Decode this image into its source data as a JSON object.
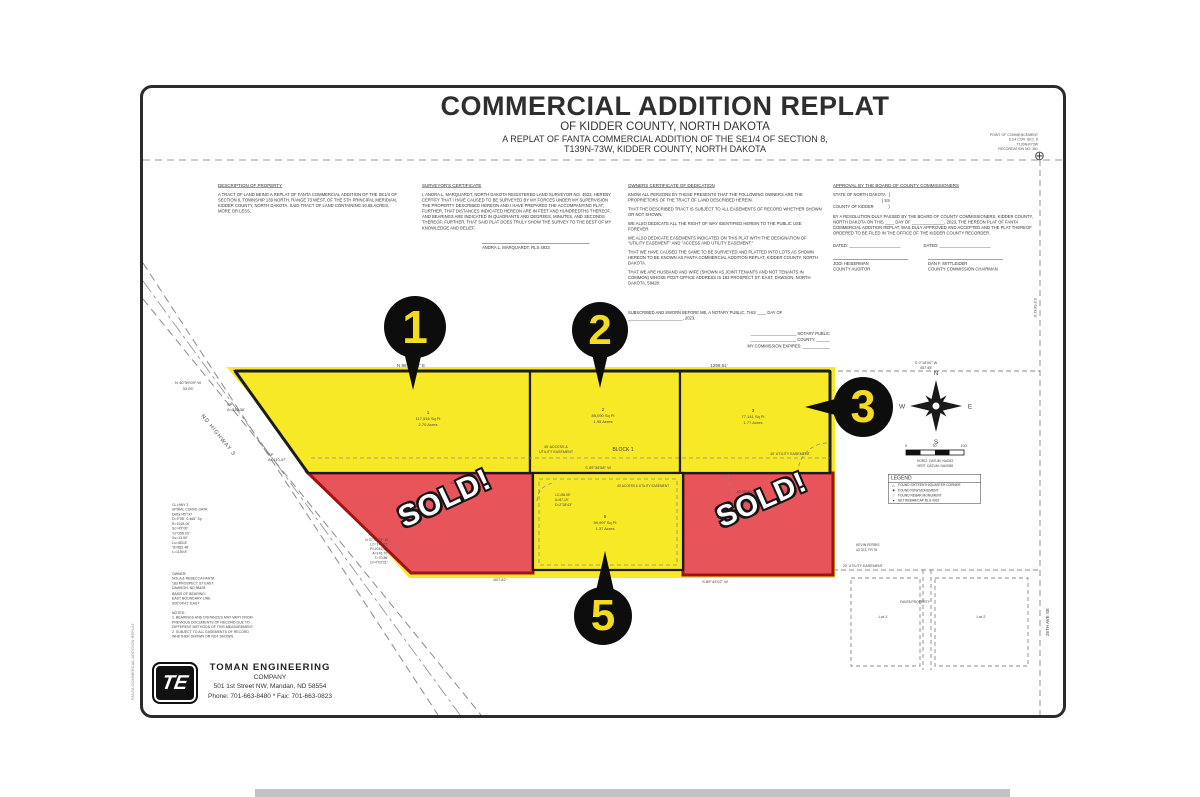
{
  "title": {
    "main": "COMMERCIAL ADDITION REPLAT",
    "sub1": "OF KIDDER COUNTY, NORTH DAKOTA",
    "sub2": "A REPLAT OF FANTA COMMERCIAL ADDITION OF THE SE1/4 OF SECTION 8,",
    "sub3": "T139N-73W, KIDDER COUNTY, NORTH DAKOTA"
  },
  "poc": {
    "l1": "POINT OF COMMENCEMENT",
    "l2": "E1/4 COR. SEC. 8",
    "l3": "T139N-R73W",
    "l4": "RECORDATION NO. 381",
    "symbol": "⊕"
  },
  "certificates": {
    "description": {
      "heading": "DESCRIPTION OF PROPERTY",
      "body": "A TRACT OF LAND BEING A REPLAT OF FANTA COMMERCIAL ADDITION OF THE SE1/4 OF SECTION 8, TOWNSHIP 139 NORTH, RANGE 73 WEST, OF THE 5TH PRINCIPAL MERIDIAN, KIDDER COUNTY, NORTH DAKOTA. SAID TRACT OF LAND CONTAINING 10.68 ACRES, MORE OR LESS."
    },
    "surveyor": {
      "heading": "SURVEYOR'S CERTIFICATE",
      "body": "I, ANDRA L. MARQUARDT, NORTH DAKOTA REGISTERED LAND SURVEYOR NO. 4933, HEREBY CERTIFY THAT I HAVE CAUSED TO BE SURVEYED BY MY FORCES UNDER MY SUPERVISION THE PROPERTY DESCRIBED HEREON AND I HAVE PREPARED THE ACCOMPANYING PLAT; FURTHER, THAT DISTANCES INDICATED HEREON ARE IN FEET AND HUNDREDTHS THEREOF, AND BEARINGS ARE INDICATED IN QUADRANTS AND DEGREES, MINUTES, AND SECONDS THEREOF; FURTHER, THAT SAID PLAT DOES TRULY SHOW THE SURVEY TO THE BEST OF MY KNOWLEDGE AND BELIEF.",
      "signature": "ANDRA L. MARQUARDT, RLS 4933"
    },
    "owners": {
      "heading": "OWNERS CERTIFICATE OF DEDICATION",
      "p1": "KNOW ALL PERSONS BY THESE PRESENTS THAT THE FOLLOWING OWNERS ARE THE PROPRIETORS OF THE TRACT OF LAND DESCRIBED HEREIN.",
      "p2": "THAT THE DESCRIBED TRACT IS SUBJECT TO ALL EASEMENTS OF RECORD WHETHER SHOWN OR NOT SHOWN.",
      "p3": "WE ALSO DEDICATE ALL THE RIGHT OF WAY IDENTIFIED HEREIN TO THE PUBLIC USE FOREVER.",
      "p4": "WE ALSO DEDICATE EASEMENTS INDICATED ON THIS PLAT WITH THE DESIGNATION OF \"UTILITY EASEMENT\" AND \"ACCESS AND UTILITY EASEMENT.\"",
      "p5": "THAT WE HAVE CAUSED THE SAME TO BE SURVEYED AND PLATTED INTO LOTS AS SHOWN HEREON TO BE KNOWN AS FANTA COMMERCIAL ADDITION REPLAT, KIDDER COUNTY, NORTH DAKOTA.",
      "p6": "THAT WE ARE HUSBAND AND WIFE (SHOWN AS JOINT TENANTS AND NOT TENANTS IN COMMON) WHOSE POST OFFICE ADDRESS IS 183 PROSPECT ST. EAST, DAWSON, NORTH DAKOTA, 58428.",
      "notary": "SUBSCRIBED AND SWORN BEFORE ME, A NOTARY PUBLIC, THIS ____ DAY OF\n________________________, 2023.",
      "notary_right": "____________________ NOTARY PUBLIC\n____________________ COUNTY, ______\nMY COMMISSION EXPIRES: ____________"
    },
    "approval": {
      "heading": "APPROVAL BY THE BOARD OF COUNTY COMMISSIONERS",
      "state_block": "STATE OF NORTH DAKOTA   )\n                                           ) SS\nCOUNTY OF KIDDER             )",
      "body": "BY A RESOLUTION DULY PASSED BY THE BOARD OF COUNTY COMMISSIONERS, KIDDER COUNTY, NORTH DAKOTA ON THIS ____ DAY OF ______________, 2023, THE HEREON PLAT OF FANTA COMMERCIAL ADDITION REPLAT, WAS DULY APPROVED AND ACCEPTED AND THE PLAT THEREOF ORDERED TO BE FILED IN THE OFFICE OF THE KIDDER COUNTY RECORDER.",
      "dated_left": "DATED: ______________________",
      "dated_right": "DATED: ______________________",
      "name_left": "JODI HEISERMAN",
      "role_left": "COUNTY AUDITOR",
      "name_right": "DAN F. MITTLEIDER",
      "role_right": "COUNTY COMMISSION CHAIRMAN"
    }
  },
  "plat": {
    "bearing_top": "N 86°38'08\" E",
    "dim_top": "1299.51'",
    "tie_bearing": "N 40°59'09\" W",
    "tie_dist": "33.05'",
    "sp1_l1": "SP",
    "sp1_l2": "A=536.36'",
    "sp2_l1": "SP",
    "sp2_l2": "A=410.47'",
    "highway": "ND HIGHWAY 3",
    "block": "BLOCK 1",
    "esmt_access_l1": "40' ACCESS &",
    "esmt_access_l2": "UTILITY EASEMENT",
    "esmt_util": "40' UTILITY EASEMENT",
    "row_bearing": "S 89°38'58\" W",
    "dim_bottom": "807.82'",
    "bearing_bottom": "S 89°44'02\" W",
    "dim_red_top": "230.97'",
    "cul1": "40' TEMPORARY",
    "cul2": "CUL-DE-SAC",
    "cul3": "EASEMENT",
    "l5c1": "LC=86.55'",
    "l5c2": "A=87.19'",
    "l5c3": "D=2°28'43\"",
    "lot5_esmt": "40' ACCESS & UTILITY EASEMENT",
    "right_b1": "S 0°18'00\" W",
    "right_b2": "457.45'",
    "east_bearing": "S 0°04'41\" E",
    "ave": "26TH AVE SE",
    "esmt20": "20' UTILITY EASEMENT",
    "lot_a": "Lot 1",
    "lot_b": "Lot 2",
    "fanta_prop": "FANTA PROPERTY",
    "curve_left": "N 37°00'22\" W\nLC=141.67'\nR=2016.00'\nA=141.70'\nT=70.86'\nD=4°02'21\"",
    "lots": {
      "lot1": {
        "num": "1",
        "sqft": "117,516 Sq Ft",
        "acres": "2.70 Acres"
      },
      "lot2": {
        "num": "2",
        "sqft": "85,090 Sq Ft",
        "acres": "1.95 Acres"
      },
      "lot3": {
        "num": "3",
        "sqft": "77,141 Sq Ft",
        "acres": "1.77 Acres"
      },
      "lot5": {
        "num": "5",
        "sqft": "59,997 Sq Ft",
        "acres": "1.37 Acres"
      }
    },
    "markers": {
      "m1": "1",
      "m2": "2",
      "m3": "3",
      "m5": "5"
    },
    "sold_label": "SOLD!"
  },
  "sides": {
    "curve_block": "CL HWY 3\nSPIRAL CURVE DATA:\nDelta=45°00'\nD=9°08', 0.466° Sp\nR=1918.06'\nSc=45°00'\nYs=358.00'\nXs=13.90'\nLs=483.8'\nTs=882.48'\nL=1189.8'",
    "owner_block": "OWNER:\nNOLA & REBECCA FANTA\n183 PROSPECT ST EAST\nDAWSON, ND 58428",
    "basis_block": "BASIS OF BEARING:\nEAST BOUNDARY LINE\nS00°04'41\" EAST",
    "notes_block": "NOTES:\n1. BEARINGS AND DISTANCES MAY VARY FROM\nPREVIOUS DOCUMENTS OF RECORD DUE TO\nDIFFERENT METHODS OF THIS MEASUREMENT.\n2. SUBJECT TO ALL EASEMENTS OF RECORD\nWHETHER SHOWN OR NOT SHOWN.",
    "unplatted_l1": "KEVIN FERRIS",
    "unplatted_l2": "43 372, FR 91",
    "edge_label": "FANTA COMMERCIAL ADDITION REPLAT"
  },
  "compass": {
    "n": "N",
    "e": "E",
    "s": "S",
    "w": "W",
    "date": "12-28-2022"
  },
  "scalebar": {
    "t0": "0",
    "t50": "50'",
    "t100": "100'",
    "datum1": "HORIZ. DATUM: NAD83",
    "datum2": "VERT. DATUM: NAVD88"
  },
  "legend": {
    "title": "LEGEND",
    "items": [
      {
        "sym": "△",
        "label": "FOUND SIXTEENTH/QUARTER CORNER"
      },
      {
        "sym": "■",
        "label": "FOUND ROW MONUMENT"
      },
      {
        "sym": "○",
        "label": "FOUND REBAR MONUMENT"
      },
      {
        "sym": "●",
        "label": "SET REBAR/CAP RLS 4933"
      }
    ]
  },
  "company": {
    "logo": "TE",
    "name": "TOMAN ENGINEERING",
    "name2": "COMPANY",
    "addr": "501 1st Street NW, Mandan, ND 58554",
    "phone": "Phone: 701-663-8480 * Fax: 701-663-0823"
  },
  "colors": {
    "lot_yellow": "#f7e926",
    "lot_red": "#e7555a",
    "red_border": "#9e1414",
    "marker_black": "#0d0d0d",
    "marker_number_yellow": "#f3dc20"
  }
}
